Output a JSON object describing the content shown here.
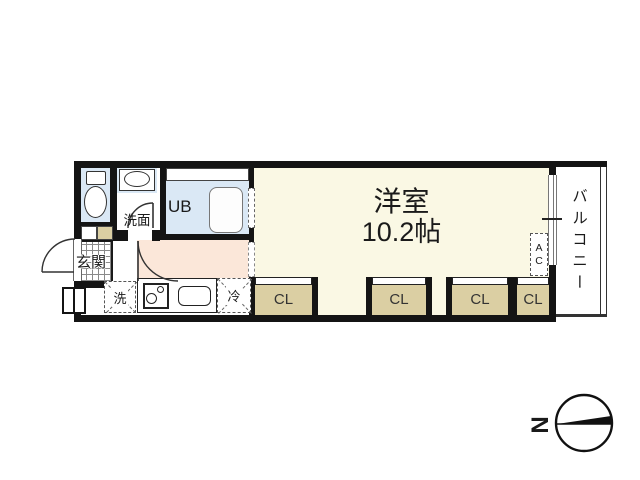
{
  "floor_plan": {
    "main_room": {
      "label": "洋室",
      "area": "10.2帖"
    },
    "balcony": {
      "label": "バルコニー"
    },
    "entrance": {
      "label": "玄関"
    },
    "washroom": {
      "label": "洗面"
    },
    "unit_bath": {
      "label": "UB"
    },
    "laundry": {
      "label": "洗"
    },
    "refrigerator": {
      "label": "冷"
    },
    "air_conditioner": {
      "label": "AC"
    },
    "closets": [
      {
        "label": "CL"
      },
      {
        "label": "CL"
      },
      {
        "label": "CL"
      },
      {
        "label": "CL"
      }
    ],
    "compass": {
      "label": "N"
    },
    "colors": {
      "wall": "#141414",
      "wet_area_floor": "#dae8f5",
      "main_room_floor": "#faf8e4",
      "corridor_floor": "#fbe7d9",
      "closet_fill": "#dbcfa3"
    }
  }
}
